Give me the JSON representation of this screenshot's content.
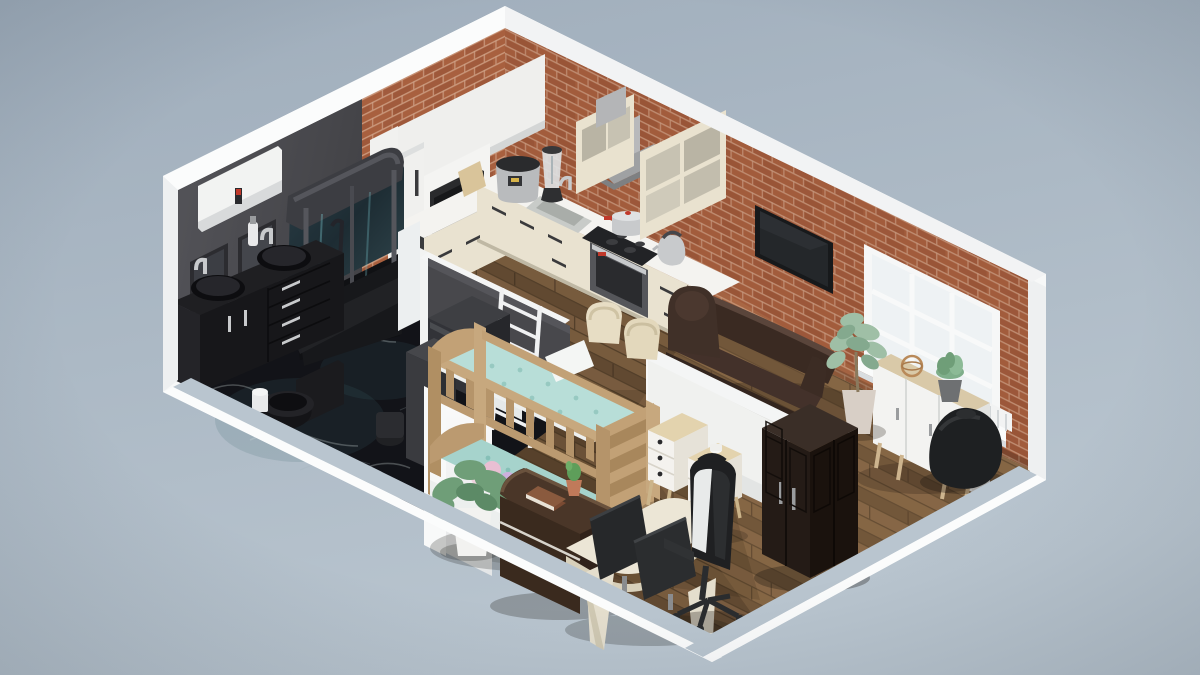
{
  "scene": {
    "kind": "isometric-3d-apartment-floorplan-render",
    "bg_top": "#9fadbb",
    "bg_bottom": "#b9c5cf"
  },
  "palette": {
    "shell_white": "#f7f8f8",
    "cut_wall_top": "#b9c5cf",
    "dark_wall": "#4a4a4e",
    "partition_dark": "#48484c",
    "partition_white": "#f0f1ef",
    "brick": "#a8603f",
    "brick_mortar": "#cfa287",
    "wood_floor": "#6f5439",
    "marble": "#121318",
    "counter_cream": "#e9e2d0",
    "counter_top": "#f4f3f0",
    "cabinet_white": "#efefed",
    "appliance_dark": "#2a2b2d",
    "steel": "#c8cacc",
    "ac_white": "#f2f3f2",
    "tv_black": "#17191b",
    "window_white": "#f6f7f7",
    "sofa_brown": "#3a2a22",
    "wardrobe_brown": "#241b16",
    "bed_wood": "#c7a87e",
    "bedding_teal": "#b8ded8",
    "sideboard_white": "#f3f3f1",
    "wood_top_light": "#d9c9a8",
    "desk_cream": "#ece6d6",
    "monitor_dark": "#26282a",
    "chair_black": "#1f2022",
    "bean_bag": "#1e2022",
    "plant_green": "#6f9e78",
    "plant_green_pale": "#9fbfa6",
    "pot_white": "#f2f2f0",
    "accent_red": "#c0392b"
  },
  "rooms": [
    {
      "name": "bathroom",
      "floor": "black-marble",
      "items": [
        "air-conditioner",
        "wall-mirror",
        "wall-mirror",
        "double-vanity",
        "vessel-sink",
        "vessel-sink",
        "soap-dispenser",
        "corner-shower-cabin",
        "toilet",
        "toilet-paper-holder",
        "bathtub",
        "washing-machine",
        "laundry-cabinet"
      ]
    },
    {
      "name": "kitchen",
      "floor": "dark-wood",
      "items": [
        "upper-cabinet-panel",
        "tall-cabinet",
        "microwave",
        "coffee-machine",
        "slow-cooker",
        "blender",
        "cutting-board",
        "sink",
        "faucet",
        "cooktop",
        "cooking-pot",
        "oven",
        "kettle",
        "range-hood",
        "open-shelf-cabinet",
        "open-shelf-cabinet",
        "counter-cabinets",
        "dining-chair",
        "dining-chair",
        "towel-ladder"
      ]
    },
    {
      "name": "living-room",
      "floor": "wood",
      "items": [
        "wall-tv",
        "window",
        "leather-sofa",
        "sideboard",
        "decor-sphere",
        "succulent-plant",
        "floor-plant",
        "bean-bag"
      ]
    },
    {
      "name": "kids-room-office",
      "floor": "dark-wood",
      "items": [
        "bunk-bed",
        "teal-bedding",
        "pillow",
        "plush-toys",
        "nightstand",
        "nightstand",
        "potted-plant",
        "wardrobe",
        "dresser-console",
        "book",
        "cactus",
        "gaming-desk",
        "monitor",
        "monitor",
        "gaming-chair"
      ]
    }
  ]
}
